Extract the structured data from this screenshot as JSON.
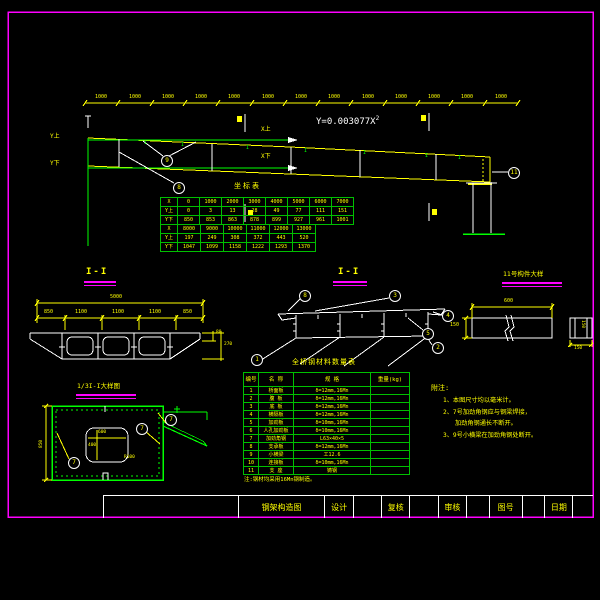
{
  "colors": {
    "primary_line": "#ffff00",
    "secondary_line": "#00ff00",
    "white_line": "#ffffff",
    "frame": "#ff00ff",
    "background": "#000000"
  },
  "elevation": {
    "span_label": "1000",
    "formula_base": "Y=0.003077X",
    "formula_exponent": "2",
    "axis_y_top": "Y上",
    "axis_y_bottom": "Y下",
    "axis_x_top": "X上",
    "axis_x_bottom": "X下",
    "i_marker": "I",
    "callouts": {
      "top": "9",
      "web": "8",
      "bearing": "11"
    }
  },
  "coord_table": {
    "title": "坐标表",
    "row_headers": [
      "X",
      "Y上",
      "Y下"
    ],
    "block1": {
      "x": [
        "0",
        "1000",
        "2000",
        "3000",
        "4000",
        "5000",
        "6000",
        "7000"
      ],
      "y_top": [
        "0",
        "3",
        "13",
        "28",
        "49",
        "77",
        "111",
        "151"
      ],
      "y_bottom": [
        "850",
        "853",
        "863",
        "878",
        "899",
        "927",
        "961",
        "1001"
      ]
    },
    "block2": {
      "x": [
        "8000",
        "9000",
        "10000",
        "11000",
        "12000",
        "13000"
      ],
      "y_top": [
        "197",
        "249",
        "308",
        "372",
        "443",
        "520"
      ],
      "y_bottom": [
        "1047",
        "1099",
        "1158",
        "1222",
        "1293",
        "1370"
      ]
    }
  },
  "section_a": {
    "title": "I-I",
    "dim_total": "5000",
    "dims": [
      "850",
      "1100",
      "1100",
      "1100",
      "850"
    ],
    "dim_slab": "80",
    "dim_depth": "270"
  },
  "section_b": {
    "title": "I-I",
    "callouts": {
      "c1": "1",
      "c2": "2",
      "c3": "3",
      "c4": "4",
      "c5": "5",
      "c8": "8"
    }
  },
  "detail_11": {
    "title": "11号构件大样",
    "dim_length": "600",
    "dim_height": "150",
    "dim_side_width": "150",
    "dim_side_height": "150"
  },
  "detail_third": {
    "title": "1/3I-I大样图",
    "dim_hole_width": "600",
    "dim_hole_height": "400",
    "dim_radius": "R100",
    "dim_depth": "850",
    "callout": "7"
  },
  "material_table": {
    "title": "全桥钢材料数量表",
    "headers": [
      "编号",
      "名 称",
      "规 格",
      "重量(kg)"
    ],
    "rows": [
      {
        "no": "1",
        "name": "桥面板",
        "spec": "δ=12mm,16Mn",
        "weight": ""
      },
      {
        "no": "2",
        "name": "腹 板",
        "spec": "δ=12mm,16Mn",
        "weight": ""
      },
      {
        "no": "3",
        "name": "底 板",
        "spec": "δ=12mm,16Mn",
        "weight": ""
      },
      {
        "no": "4",
        "name": "横隔板",
        "spec": "δ=12mm,16Mn",
        "weight": ""
      },
      {
        "no": "5",
        "name": "加劲板",
        "spec": "δ=10mm,16Mn",
        "weight": ""
      },
      {
        "no": "6",
        "name": "人孔加劲板",
        "spec": "δ=10mm,16Mn",
        "weight": ""
      },
      {
        "no": "7",
        "name": "加劲角钢",
        "spec": "L63×40×5",
        "weight": ""
      },
      {
        "no": "8",
        "name": "支承板",
        "spec": "δ=12mm,16Mn",
        "weight": ""
      },
      {
        "no": "9",
        "name": "小横梁",
        "spec": "工12.6",
        "weight": ""
      },
      {
        "no": "10",
        "name": "连接板",
        "spec": "δ=10mm,16Mn",
        "weight": ""
      },
      {
        "no": "11",
        "name": "支 座",
        "spec": "铸钢",
        "weight": ""
      }
    ],
    "note": "注:钢材均采用16Mn钢制造。"
  },
  "notes": {
    "title": "附注:",
    "items": [
      "1、本图尺寸均以毫米计。",
      "2、7号加劲角钢应与钢梁焊接，",
      "加劲角钢通长不断开。",
      "3、9号小横梁在加劲角钢处断开。"
    ]
  },
  "title_block": {
    "drawing_title": "钢架构造图",
    "design_label": "设计",
    "check_label": "复核",
    "review_label": "审核",
    "number_label": "图号",
    "date_label": "日期"
  }
}
